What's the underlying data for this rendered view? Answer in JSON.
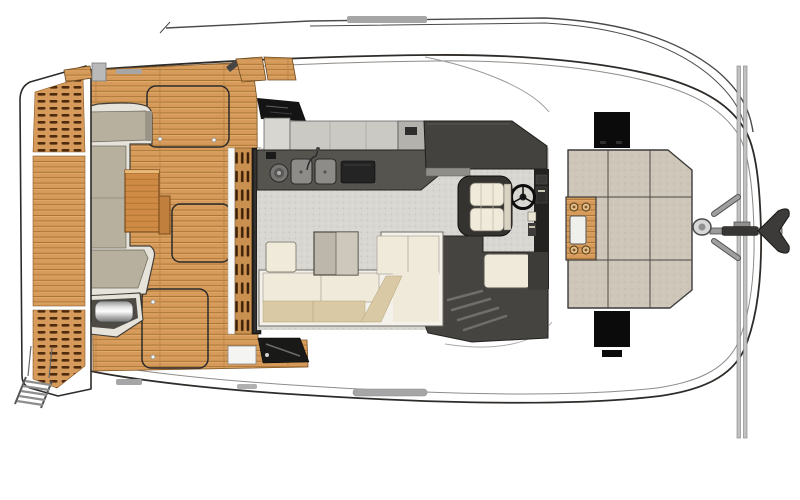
{
  "diagram": {
    "type": "boat-deck-floor-plan",
    "subject": "power-catamaran-main-deck-top-view",
    "orientation": "bow-right-stern-left"
  },
  "areas": [
    "swim-platform",
    "swim-ladder",
    "engine-vent-grilles",
    "aft-cockpit-teak-deck",
    "cockpit-l-sofa",
    "cockpit-table",
    "deck-hatches",
    "grill-unit",
    "sliding-door",
    "salon-carpet",
    "galley-counter",
    "double-sink",
    "cooktop",
    "overhead-cabinets",
    "tv-panel",
    "helm-console",
    "steering-wheel",
    "helm-seat",
    "companionway-stairs",
    "salon-l-sofa",
    "salon-table",
    "ottoman",
    "side-decks",
    "foredeck-sunpad",
    "sunpad-teak-insert",
    "foredeck-hatches",
    "anchor-windlass",
    "bow-crossbeam",
    "bow-rails",
    "anchor"
  ],
  "colors": {
    "line": "#2e2b28",
    "line_soft": "#8f8c88",
    "teak_base": "#d69a5a",
    "teak_light": "#e3ad70",
    "teak_dark": "#a5702f",
    "teak_seam": "#bb8448",
    "vent_dash": "#4e2a0e",
    "sofa_frame": "#e6e3da",
    "sofa_cushion": "#b8b09f",
    "wood_table": "#cf8b45",
    "wood_table_edge": "#7a4c1b",
    "slat_dark": "#3d2008",
    "door_track": "#232220",
    "glass_dark": "#191917",
    "carpet": "#d9d7d2",
    "carpet_dot": "#c7c4bf",
    "cabinet_light": "#cbc9c4",
    "cabinet_mid": "#b4b2ac",
    "counter": "#56544f",
    "counter_edge": "#26241f",
    "appliance_black": "#141414",
    "steel": "#8e8c89",
    "console": "#44423f",
    "dash_black": "#232220",
    "seat_cream": "#efead9",
    "seat_tan": "#d9c9a4",
    "stair_dark": "#464441",
    "tread": "#706e69",
    "sunpad": "#cec7b9",
    "sunpad_dot": "#bdb5a5",
    "hatch_black": "#0b0b0b",
    "metal_light": "#d8d8d8",
    "rail_gray": "#9f9f9f",
    "anchor_dark": "#3c3b39",
    "handle_gray": "#a6a6a6"
  }
}
